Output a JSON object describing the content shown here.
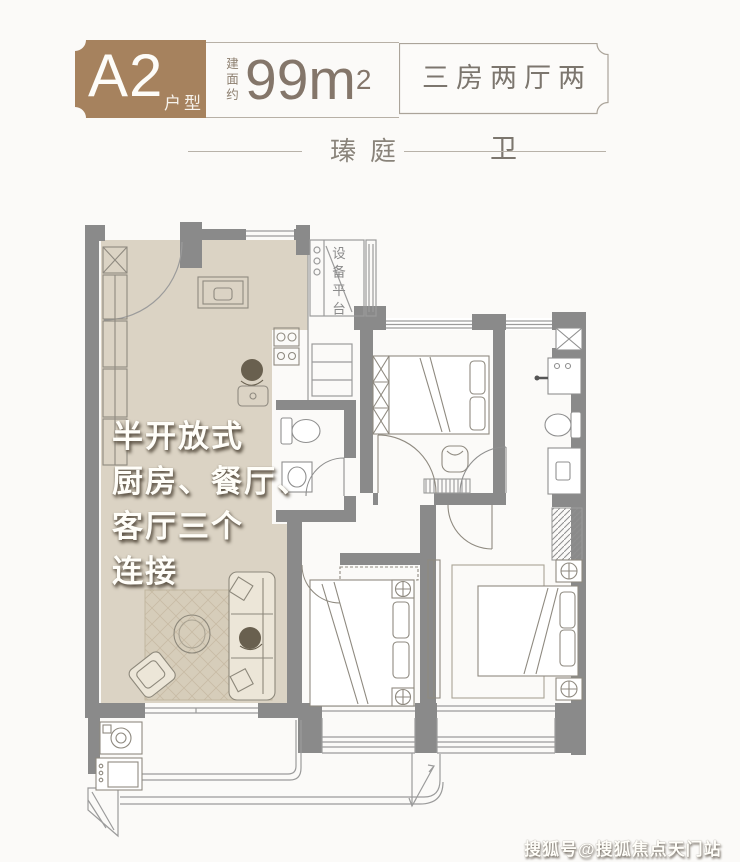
{
  "header": {
    "badge": {
      "code": "A2",
      "suffix": "户型",
      "color": "#a6825e"
    },
    "area": {
      "prefix": "建面约",
      "value": "99",
      "unit": "m",
      "sup": "2"
    },
    "spec_box": {
      "text": "三房两厅两卫"
    }
  },
  "title": {
    "project_name": "瑧庭"
  },
  "floor_plan": {
    "wall_color": "#8a8a8a",
    "highlight_color": "#dbd3c4",
    "platform_label": "设备平台",
    "annotation_lines": [
      "半开放式",
      "厨房、餐厅、",
      "客厅三个",
      "连接"
    ]
  },
  "watermark": {
    "text": "搜狐号@搜狐焦点天门站"
  }
}
